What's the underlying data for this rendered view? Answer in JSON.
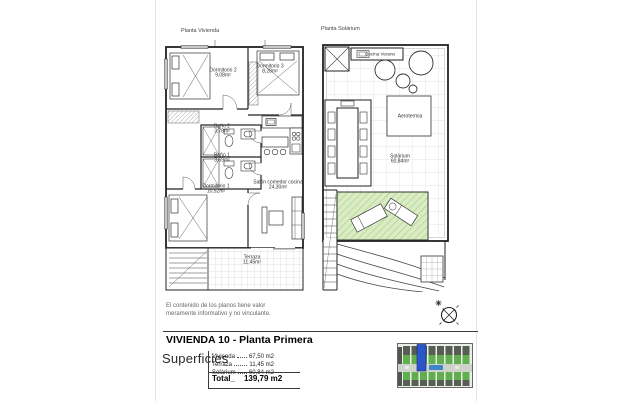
{
  "sheet": {
    "disclaimer_line1": "El contenido de los planos tiene valor",
    "disclaimer_line2": "meramente informativo y no vinculante.",
    "title": "VIVIENDA 10 - Planta Primera",
    "superficies_label": "Superficies",
    "rows": [
      {
        "label": "Vivienda",
        "value": "67,50 m2"
      },
      {
        "label": "Terraza",
        "value": "11,45 m2"
      },
      {
        "label": "Solárium",
        "value": "60,84 m2"
      }
    ],
    "total": {
      "label": "Total_",
      "value": "139,79 m2"
    }
  },
  "left_plan": {
    "title": "Planta Vivienda",
    "labels": [
      {
        "name": "Dormitorio 2",
        "area": "9,08m²"
      },
      {
        "name": "Dormitorio 3",
        "area": "8,28m²"
      },
      {
        "name": "Baño 2",
        "area": "3,78m²"
      },
      {
        "name": "Baño 1",
        "area": "3,69m²"
      },
      {
        "name": "Dormitorio 1",
        "area": "10,52m²"
      },
      {
        "name": "Salón comedor cocina",
        "area": "24,30m²"
      },
      {
        "name": "Terraza",
        "area": "11,45m²"
      }
    ]
  },
  "right_plan": {
    "title": "Planta Solárium",
    "labels": [
      {
        "name": "Cocina Verano",
        "area": ""
      },
      {
        "name": "Aerotermia",
        "area": ""
      },
      {
        "name": "Solárium",
        "area": "60,84m²"
      }
    ]
  },
  "colors": {
    "wall": "#222222",
    "tile_grid": "#c6c6c6",
    "solarium_fill": "#d9ecc3",
    "solarium_hatch": "#a3cb81",
    "thumb_green": "#61ae4e",
    "thumb_roof": "#565f52",
    "thumb_blue": "#2b55c9",
    "thumb_pool": "#3f86c9"
  }
}
